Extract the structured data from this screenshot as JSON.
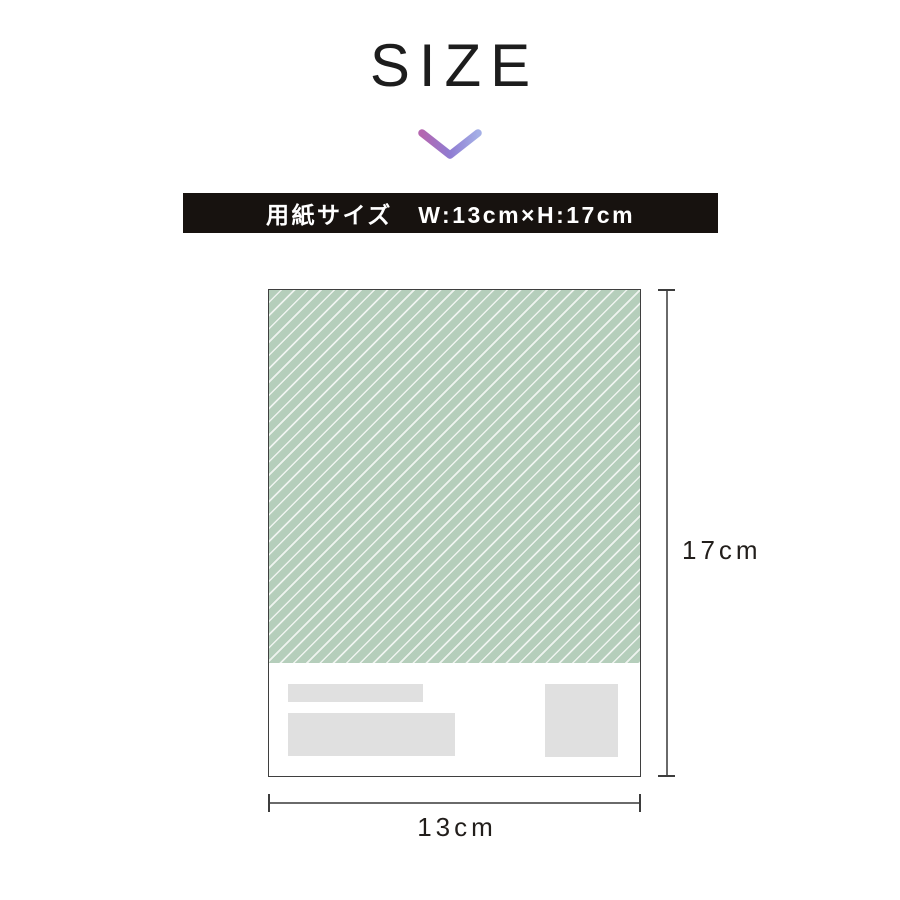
{
  "title": "SIZE",
  "chevron": {
    "direction": "down",
    "gradient": [
      "#b566b0",
      "#8f7cd2",
      "#a4afe6"
    ]
  },
  "banner": {
    "text": "用紙サイズ　W:13cm×H:17cm",
    "background": "#17120f",
    "text_color": "#ffffff"
  },
  "diagram": {
    "paper": {
      "width_cm": 13,
      "height_cm": 17,
      "stripe_fill": "#b5cebb",
      "stripe_line": "#eef3ef",
      "border_color": "#3f3f3f",
      "placeholder_color": "#e0e0e0",
      "placeholder_count": 3
    },
    "height_label": "17cm",
    "width_label": "13cm",
    "dimension_line_color": "#6a6a6a"
  }
}
